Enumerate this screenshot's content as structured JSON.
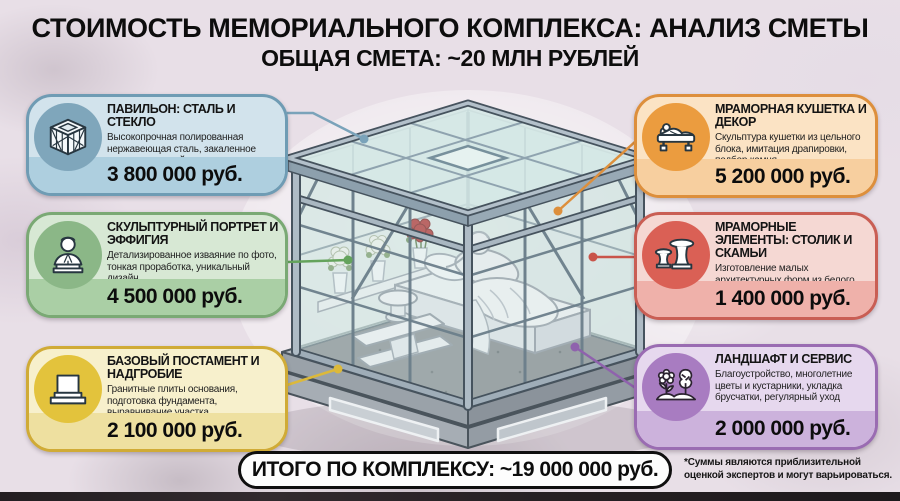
{
  "header": {
    "title": "СТОИМОСТЬ МЕМОРИАЛЬНОГО КОМПЛЕКСА: АНАЛИЗ СМЕТЫ",
    "subtitle": "ОБЩАЯ СМЕТА: ~20 МЛН РУБЛЕЙ"
  },
  "cards": [
    {
      "side": "left",
      "icon": "glass-pavilion-icon",
      "title": "ПАВИЛЬОН: СТАЛЬ И СТЕКЛО",
      "description": "Высокопрочная полированная нержавеющая сталь, закаленное стекло с защитой, профессиональный монтаж.",
      "price": "3 800 000 руб.",
      "colors": {
        "bg": "#d2e3ec",
        "band": "#aecfdf",
        "bd": "#6f9cb4",
        "circ": "#7fa6bb",
        "line": "#7aa3ba"
      }
    },
    {
      "side": "left",
      "icon": "bust-icon",
      "title": "СКУЛЬПТУРНЫЙ ПОРТРЕТ И ЭФФИГИЯ",
      "description": "Детализированное изваяние по фото, тонкая проработка, уникальный дизайн",
      "price": "4 500 000 руб.",
      "colors": {
        "bg": "#d7e8d4",
        "band": "#aacfa5",
        "bd": "#7aa974",
        "circ": "#8bb787",
        "line": "#64a35c"
      }
    },
    {
      "side": "left",
      "icon": "pedestal-icon",
      "title": "БАЗОВЫЙ ПОСТАМЕНТ И НАДГРОБИЕ",
      "description": "Гранитные плиты основания, подготовка фундамента, выравнивание участка",
      "price": "2 100 000 руб.",
      "colors": {
        "bg": "#f7f0cc",
        "band": "#eee0a0",
        "bd": "#d0ab36",
        "circ": "#e3c33c",
        "line": "#dcb93a"
      }
    },
    {
      "side": "right",
      "icon": "marble-couch-icon",
      "title": "МРАМОРНАЯ КУШЕТКА И ДЕКОР",
      "description": "Скульптура кушетки из цельного блока, имитация драпировки, подбор камня",
      "price": "5 200 000 руб.",
      "colors": {
        "bg": "#fbe3c4",
        "band": "#f7cf9f",
        "bd": "#dd8f3c",
        "circ": "#eb9c3f",
        "line": "#dd8f3c"
      }
    },
    {
      "side": "right",
      "icon": "table-bench-icon",
      "title": "МРАМОРНЫЕ ЭЛЕМЕНТЫ: СТОЛИК И СКАМЬИ",
      "description": "Изготовление малых архитектурных форм из белого мрамора (столик, 2 скамьи).",
      "price": "1 400 000 руб.",
      "colors": {
        "bg": "#f5d8d3",
        "band": "#efb1aa",
        "bd": "#c95e54",
        "circ": "#da6055",
        "line": "#c9544a"
      }
    },
    {
      "side": "right",
      "icon": "landscape-icon",
      "title": "ЛАНДШАФТ И СЕРВИС",
      "description": "Благоустройство, многолетние цветы и кустарники, укладка брусчатки, регулярный уход",
      "price": "2 000 000 руб.",
      "colors": {
        "bg": "#e6d8ee",
        "band": "#ccb2dc",
        "bd": "#9a6cb2",
        "circ": "#a87cc1",
        "line": "#8f62ad"
      }
    }
  ],
  "total_label": "ИТОГО ПО КОМПЛЕКСУ: ~19 000 000 руб.",
  "footnote": "*Суммы являются приблизительной оценкой экспертов и могут варьироваться."
}
